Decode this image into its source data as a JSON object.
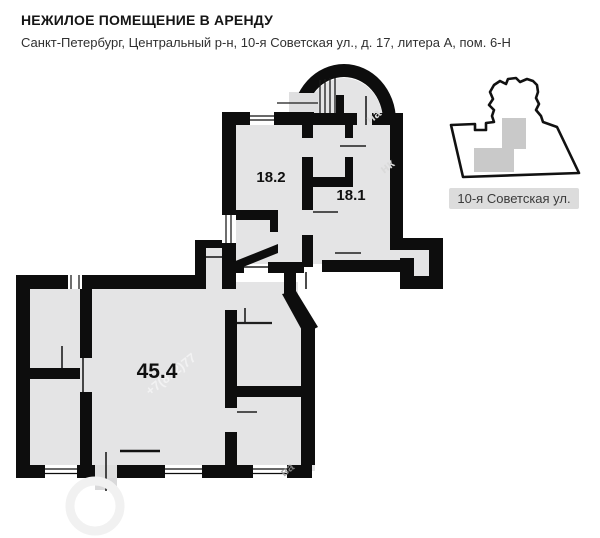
{
  "header": {
    "title": "НЕЖИЛОЕ ПОМЕЩЕНИЕ В АРЕНДУ",
    "address": "Санкт-Петербург, Центральный р-н, 10-я Советская ул., д. 17, литера А, пом. 6-Н"
  },
  "plan": {
    "rooms": [
      {
        "label": "18.2"
      },
      {
        "label": "18.1"
      },
      {
        "label": "45.4"
      }
    ]
  },
  "inset": {
    "street_label": "10-я Советская ул."
  },
  "watermark": {
    "fragments": [
      "+7(812)77",
      "на",
      "нк",
      "ва"
    ]
  },
  "colors": {
    "wall": "#0d0d0d",
    "floor": "#e4e4e5",
    "inset_footprint": "#c9c9c9",
    "inset_label_bg": "#dcdcdc"
  }
}
